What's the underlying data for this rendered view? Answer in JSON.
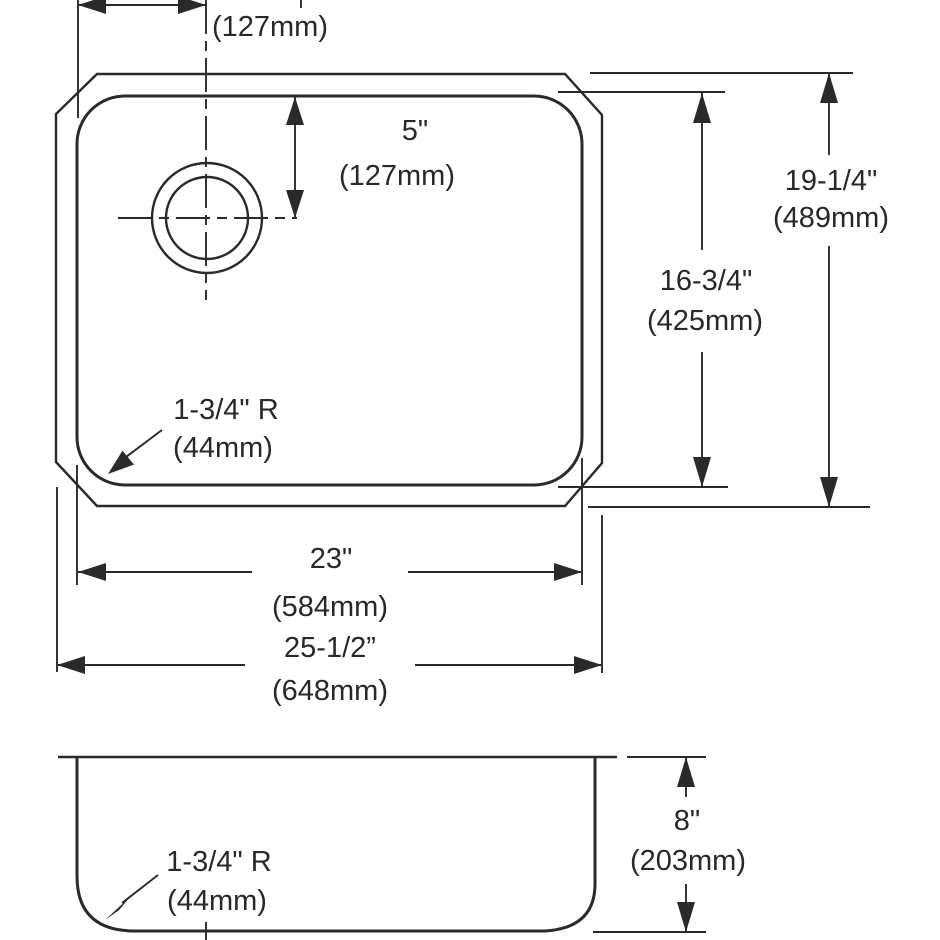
{
  "drawing": {
    "type": "sink-dimension-drawing",
    "colors": {
      "line": "#2a2a2a",
      "background": "#ffffff"
    },
    "top_view": {
      "faucet_offset_horizontal": {
        "value_mm": "(127mm)"
      },
      "faucet_offset_vertical": {
        "value_in": "5\"",
        "value_mm": "(127mm)"
      },
      "overall_depth_dim": {
        "value_in": "19-1/4\"",
        "value_mm": "(489mm)"
      },
      "bowl_depth_dim": {
        "value_in": "16-3/4\"",
        "value_mm": "(425mm)"
      },
      "corner_radius_note": {
        "line1": "1-3/4\" R",
        "line2": "(44mm)"
      },
      "bowl_width_dim": {
        "value_in": "23\"",
        "value_mm": "(584mm)"
      },
      "overall_width_dim": {
        "value_in": "25-1/2”",
        "value_mm": "(648mm)"
      }
    },
    "side_view": {
      "bowl_height_dim": {
        "value_in": "8\"",
        "value_mm": "(203mm)"
      },
      "corner_radius_note": {
        "line1": "1-3/4\" R",
        "line2": "(44mm)"
      }
    }
  }
}
